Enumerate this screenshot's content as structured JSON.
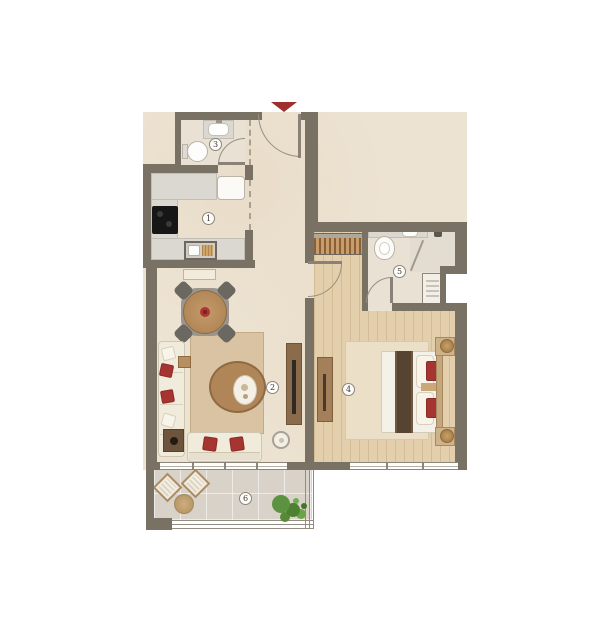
{
  "plan": {
    "rooms": [
      {
        "number": "1",
        "type": "kitchen"
      },
      {
        "number": "2",
        "type": "living-dining"
      },
      {
        "number": "3",
        "type": "bathroom"
      },
      {
        "number": "4",
        "type": "bedroom"
      },
      {
        "number": "5",
        "type": "ensuite-bathroom"
      },
      {
        "number": "6",
        "type": "balcony"
      }
    ],
    "entrance": {
      "marker": "down-arrow",
      "arrow_color": "#9e2f2d"
    },
    "palette": {
      "wall": "#7a7165",
      "floor_cream": "#ede3d2",
      "floor_wood": "#e3cfab",
      "floor_bath": "#e9e1d4",
      "floor_balcony": "#d8d2c9",
      "accent_red": "#a63532",
      "counter_gray": "#dbd8d1",
      "wood_light": "#b78f61",
      "wood_dark": "#8a6b4b",
      "bed_runner": "#564330",
      "plant_green": "#5d9340"
    }
  }
}
